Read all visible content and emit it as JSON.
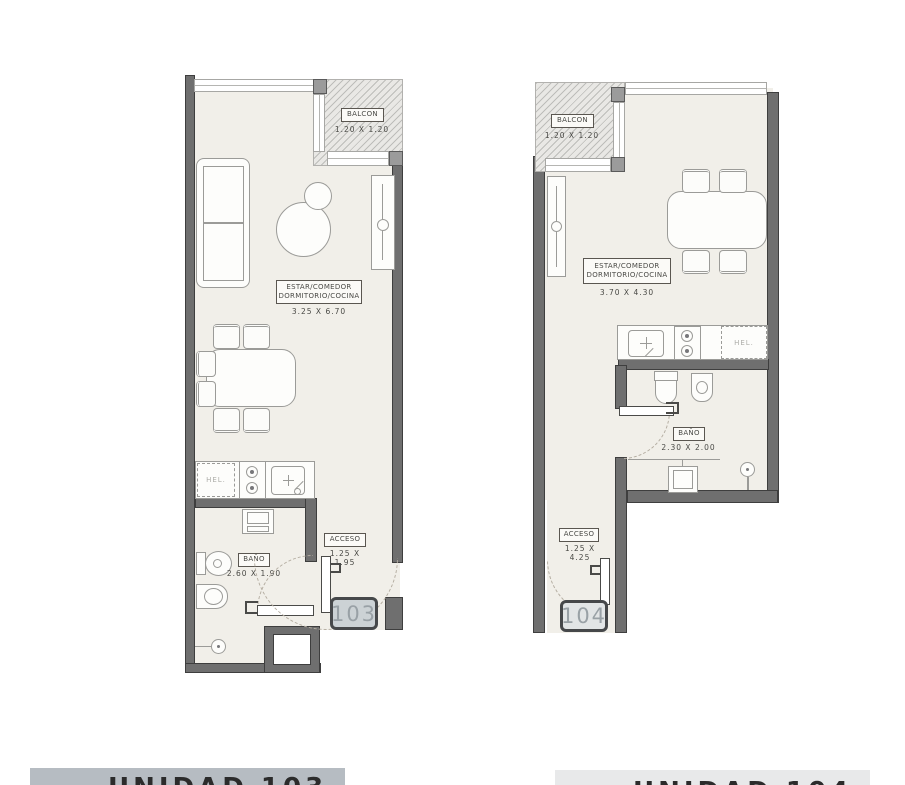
{
  "colors": {
    "wall": "#6f6f6f",
    "wall_edge": "#3e3e3e",
    "floor": "#f1efe9",
    "balcony_bg": "#e9e8e5",
    "hatch_line": "#a0a09d",
    "furniture_line": "#9b9b98",
    "label_text": "#4a4a46",
    "badge_border": "#46484a",
    "badge103_fill": "#ccd2d5",
    "badge104_fill": "#e2e5e6",
    "badge_text": "#99a1a6",
    "footer_left_bar": "#b6bcc2",
    "footer_right_bar": "#e8e9ea",
    "footer_text": "#2b2b2b"
  },
  "unit103": {
    "badge": "103",
    "balcony_title": "BALCON",
    "balcony_dims": "1.20 X 1.20",
    "room_line1": "ESTAR/COMEDOR",
    "room_line2": "DORMITORIO/COCINA",
    "room_dims": "3.25 X 6.70",
    "fridge": "HEL.",
    "bath_title": "BAÑO",
    "bath_dims": "2.60 X 1.90",
    "access_title": "ACCESO",
    "access_dims": "1.25 X 1.95",
    "footer": "UNIDAD 103"
  },
  "unit104": {
    "badge": "104",
    "balcony_title": "BALCON",
    "balcony_dims": "1.20 X 1.20",
    "room_line1": "ESTAR/COMEDOR",
    "room_line2": "DORMITORIO/COCINA",
    "room_dims": "3.70 X 4.30",
    "fridge": "HEL.",
    "bath_title": "BAÑO",
    "bath_dims": "2.30 X 2.00",
    "access_title": "ACCESO",
    "access_dims": "1.25 X 4.25",
    "footer": "UNIDAD 104"
  }
}
